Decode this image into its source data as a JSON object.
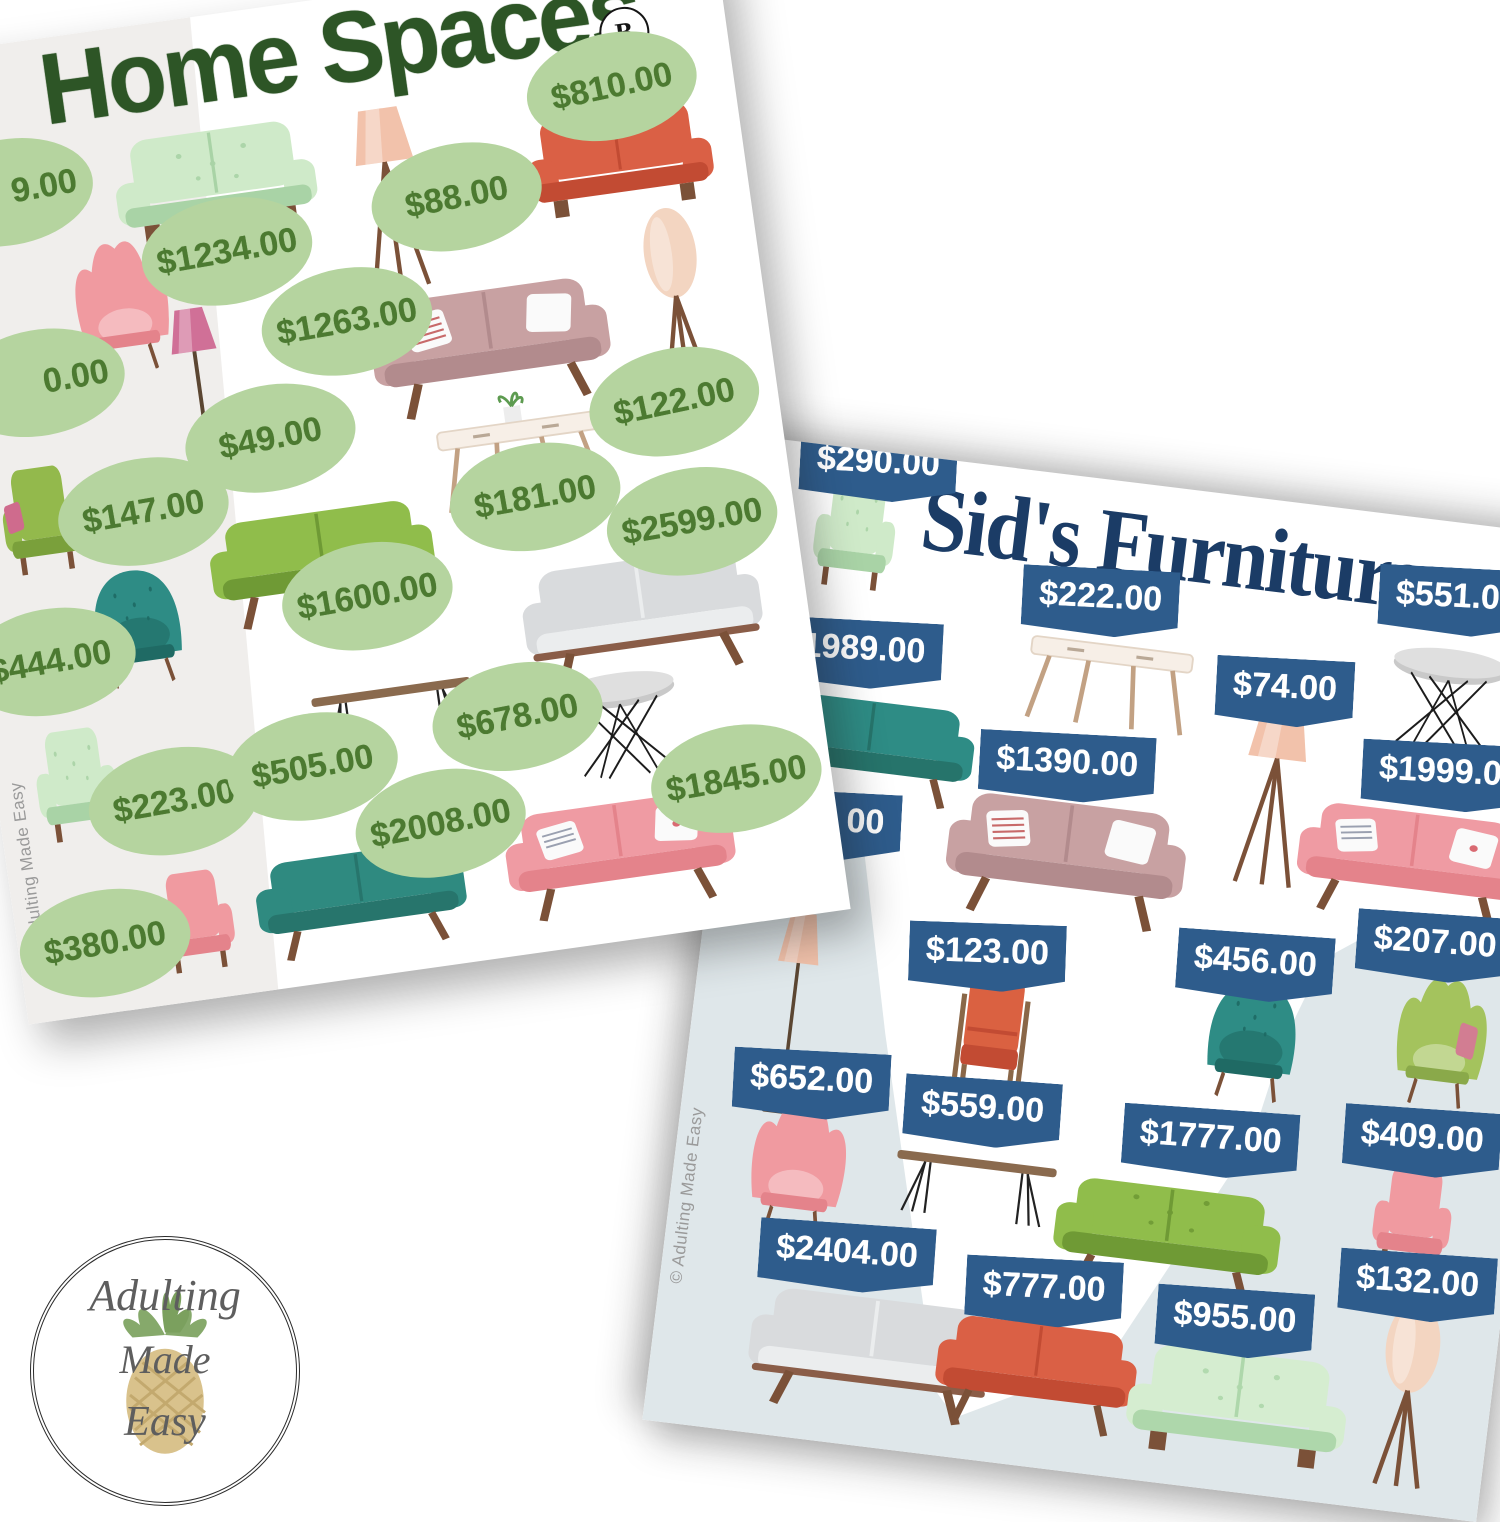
{
  "page": {
    "background": "#ffffff"
  },
  "home_card": {
    "title": "Home Spaces",
    "badge": "B",
    "copyright": "© Adulting Made Easy",
    "colors": {
      "title": "#2d5526",
      "tag_bg": "#b5d49f",
      "tag_text": "#4c7a31",
      "side_band": "#f0eeec"
    },
    "items": [
      {
        "name": "price-only-cut",
        "price": "9.00",
        "tag": {
          "x": 95,
          "y": 148,
          "rot": -2,
          "align": "right"
        },
        "furniture": null
      },
      {
        "name": "wing-chair-pink",
        "price": "0.00",
        "tag": {
          "x": 100,
          "y": 341,
          "rot": -2,
          "align": "right"
        },
        "furniture": {
          "k": "wing",
          "c": "#f09aa0",
          "d": "#e4838b",
          "x": 193,
          "y": 274,
          "w": 118,
          "h": 138
        }
      },
      {
        "name": "armchair-green",
        "price": "$147.00",
        "tag": {
          "x": 185,
          "y": 483,
          "rot": -2
        },
        "furniture": {
          "k": "arm",
          "c": "#93b94c",
          "d": "#7aa03b",
          "p": "#cf6b8d",
          "x": 83,
          "y": 479,
          "w": 110,
          "h": 124
        }
      },
      {
        "name": "tub-chair-teal",
        "price": "$444.00",
        "tag": {
          "x": 72,
          "y": 619,
          "rot": -2
        },
        "furniture": {
          "k": "tub",
          "c": "#2e8c85",
          "d": "#1f6a64",
          "x": 163,
          "y": 596,
          "w": 120,
          "h": 124
        }
      },
      {
        "name": "armchair-mint",
        "price": "$223.00",
        "tag": {
          "x": 175,
          "y": 774,
          "rot": -2
        },
        "furniture": {
          "k": "arm",
          "c": "#cfeac9",
          "d": "#a9d3a6",
          "s": 1,
          "x": 81,
          "y": 746,
          "w": 114,
          "h": 130
        }
      },
      {
        "name": "armchair-pink",
        "price": "$380.00",
        "tag": {
          "x": 87,
          "y": 905,
          "rot": -2
        },
        "furniture": {
          "k": "arm",
          "c": "#f09aa0",
          "d": "#e4838b",
          "x": 179,
          "y": 897,
          "w": 107,
          "h": 117
        }
      },
      {
        "name": "loveseat-mint",
        "price": "$1234.00",
        "tag": {
          "x": 304,
          "y": 237,
          "rot": -2
        },
        "furniture": {
          "k": "sofa2",
          "c": "#cfeac9",
          "d": "#a9d3a6",
          "s": 1,
          "x": 302,
          "y": 170,
          "w": 218,
          "h": 127
        }
      },
      {
        "name": "floor-lamp-tripod-peach",
        "price": "$88.00",
        "tag": {
          "x": 539,
          "y": 215,
          "rot": -3
        },
        "furniture": {
          "k": "tripod",
          "c": "#f2c2ab",
          "x": 472,
          "y": 207,
          "w": 97,
          "h": 192
        }
      },
      {
        "name": "loveseat-orange",
        "price": "$810.00",
        "tag": {
          "x": 708,
          "y": 127,
          "rot": -4
        },
        "furniture": {
          "k": "sofa2",
          "c": "#da6045",
          "d": "#c24b33",
          "x": 705,
          "y": 204,
          "w": 202,
          "h": 122
        }
      },
      {
        "name": "floor-lamp-pink",
        "price": "$49.00",
        "tag": {
          "x": 321,
          "y": 428,
          "rot": -3
        },
        "furniture": {
          "k": "pole",
          "c": "#d07097",
          "x": 257,
          "y": 374,
          "w": 87,
          "h": 187
        }
      },
      {
        "name": "sofa-mauve",
        "price": "$1263.00",
        "tag": {
          "x": 413,
          "y": 323,
          "rot": -2
        },
        "furniture": {
          "k": "sofa",
          "c": "#c8a1a2",
          "d": "#b28b8d",
          "pl": "mauve",
          "x": 552,
          "y": 362,
          "w": 248,
          "h": 137
        }
      },
      {
        "name": "floor-lamp-oval-beige",
        "price": "$122.00",
        "tag": {
          "x": 726,
          "y": 448,
          "rot": -4
        },
        "furniture": {
          "k": "oval",
          "c": "#f3d5c1",
          "x": 742,
          "y": 347,
          "w": 87,
          "h": 197
        }
      },
      {
        "name": "console-table",
        "price": "$181.00",
        "tag": {
          "x": 575,
          "y": 523,
          "rot": -2
        },
        "furniture": {
          "k": "console",
          "plant": 1,
          "x": 567,
          "y": 470,
          "w": 188,
          "h": 117
        }
      },
      {
        "name": "sofa-green",
        "price": "$1600.00",
        "tag": {
          "x": 395,
          "y": 598,
          "rot": -2
        },
        "furniture": {
          "k": "sofa",
          "c": "#90bd4b",
          "d": "#6f9a35",
          "x": 355,
          "y": 554,
          "w": 233,
          "h": 124
        }
      },
      {
        "name": "sofa-gray",
        "price": "$2599.00",
        "tag": {
          "x": 727,
          "y": 569,
          "rot": -2
        },
        "furniture": {
          "k": "sofa",
          "c": "#d9dbdd",
          "d": "#ebedee",
          "frame": 1,
          "x": 665,
          "y": 650,
          "w": 248,
          "h": 137
        }
      },
      {
        "name": "coffee-table-hairpin",
        "price": "$505.00",
        "tag": {
          "x": 317,
          "y": 759,
          "rot": -2
        },
        "furniture": {
          "k": "hairpin",
          "x": 405,
          "y": 702,
          "w": 178,
          "h": 102
        }
      },
      {
        "name": "side-table-wire",
        "price": "$678.00",
        "tag": {
          "x": 527,
          "y": 738,
          "rot": -3
        },
        "furniture": {
          "k": "wire",
          "x": 630,
          "y": 754,
          "w": 138,
          "h": 120
        }
      },
      {
        "name": "sofa-teal",
        "price": "$2008.00",
        "tag": {
          "x": 436,
          "y": 833,
          "rot": -3
        },
        "furniture": {
          "k": "sofa",
          "c": "#2f8a80",
          "d": "#27756c",
          "x": 347,
          "y": 893,
          "w": 218,
          "h": 114
        }
      },
      {
        "name": "sofa-pink",
        "price": "$1845.00",
        "tag": {
          "x": 735,
          "y": 830,
          "rot": -2
        },
        "furniture": {
          "k": "sofa",
          "c": "#ef9ba3",
          "d": "#e4838b",
          "pl": "pink",
          "x": 610,
          "y": 884,
          "w": 238,
          "h": 124
        }
      }
    ]
  },
  "sids_card": {
    "title": "Sid's Furniture",
    "copyright": "© Adulting Made Easy",
    "colors": {
      "title": "#1b3c66",
      "tag_bg": "#2e5c8c",
      "tag_text": "#ffffff",
      "floor_shade": "#dfe7ea"
    },
    "items": [
      {
        "name": "armchair-mint",
        "price": "$290.00",
        "tag": {
          "x": 118,
          "y": 16,
          "rot": -4
        },
        "furniture": {
          "k": "arm",
          "c": "#cfeac9",
          "d": "#a9d3a6",
          "s": 1,
          "x": 103,
          "y": 86,
          "w": 114,
          "h": 130
        }
      },
      {
        "name": "sofa-teal",
        "price": "$1989.00",
        "tag": {
          "x": 117,
          "y": 204,
          "rot": -4
        },
        "furniture": {
          "k": "sofa",
          "c": "#2e8c85",
          "d": "#26746b",
          "x": 143,
          "y": 292,
          "w": 218,
          "h": 114
        }
      },
      {
        "name": "console-table",
        "price": "$222.00",
        "tag": {
          "x": 355,
          "y": 123,
          "rot": -4
        },
        "furniture": {
          "k": "console",
          "x": 373,
          "y": 188,
          "w": 188,
          "h": 117
        }
      },
      {
        "name": "side-table-wire",
        "price": "$551.00",
        "tag": {
          "x": 709,
          "y": 79,
          "rot": -4
        },
        "furniture": {
          "k": "wire",
          "x": 710,
          "y": 172,
          "w": 138,
          "h": 120
        }
      },
      {
        "name": "floor-lamp-tripod-peach",
        "price": "$74.00",
        "tag": {
          "x": 549,
          "y": 190,
          "rot": -4
        },
        "furniture": {
          "k": "tripod",
          "c": "#f2c2ab",
          "x": 549,
          "y": 293,
          "w": 97,
          "h": 192
        }
      },
      {
        "name": "sofa-mauve",
        "price": "$1390.00",
        "tag": {
          "x": 342,
          "y": 291,
          "rot": -4
        },
        "furniture": {
          "k": "sofa",
          "c": "#c8a1a2",
          "d": "#b28b8d",
          "pl": "mauve",
          "x": 352,
          "y": 377,
          "w": 248,
          "h": 137
        }
      },
      {
        "name": "sofa-pink",
        "price": "$1999.00",
        "tag": {
          "x": 723,
          "y": 254,
          "rot": -4
        },
        "furniture": {
          "k": "sofa",
          "c": "#ef9ba3",
          "d": "#e4838b",
          "pl": "pink",
          "x": 696,
          "y": 340,
          "w": 238,
          "h": 124
        }
      },
      {
        "name": "floor-lamp-pole",
        "price": "00",
        "tag": {
          "x": 110,
          "y": 378,
          "rot": -4,
          "align": "right"
        },
        "furniture": {
          "k": "pole",
          "c": "#f2c2ab",
          "x": 99,
          "y": 568,
          "w": 78,
          "h": 218
        }
      },
      {
        "name": "chair-orange-wood",
        "price": "$123.00",
        "tag": {
          "x": 286,
          "y": 489,
          "rot": -5
        },
        "furniture": {
          "k": "armW",
          "c": "#da6141",
          "d": "#c24b33",
          "x": 300,
          "y": 565,
          "w": 114,
          "h": 130
        }
      },
      {
        "name": "tub-chair-teal",
        "price": "$456.00",
        "tag": {
          "x": 553,
          "y": 466,
          "rot": -3
        },
        "furniture": {
          "k": "tub",
          "c": "#2e8c85",
          "d": "#1f6a64",
          "x": 559,
          "y": 538,
          "w": 122,
          "h": 127
        }
      },
      {
        "name": "wing-chair-green",
        "price": "$207.00",
        "tag": {
          "x": 729,
          "y": 425,
          "rot": -3
        },
        "furniture": {
          "k": "wing",
          "c": "#a4c35d",
          "d": "#8aa94a",
          "p": "#d27d92",
          "x": 747,
          "y": 515,
          "w": 114,
          "h": 134
        }
      },
      {
        "name": "wing-chair-pink",
        "price": "$652.00",
        "tag": {
          "x": 127,
          "y": 637,
          "rot": -4
        },
        "furniture": {
          "k": "wing",
          "c": "#f09aa0",
          "d": "#e4838b",
          "x": 124,
          "y": 718,
          "w": 120,
          "h": 140
        }
      },
      {
        "name": "coffee-table-hairpin",
        "price": "$559.00",
        "tag": {
          "x": 300,
          "y": 644,
          "rot": -3
        },
        "furniture": {
          "k": "hairpin",
          "x": 301,
          "y": 701,
          "w": 178,
          "h": 102
        }
      },
      {
        "name": "sofa-green",
        "price": "$1777.00",
        "tag": {
          "x": 530,
          "y": 646,
          "rot": -3
        },
        "furniture": {
          "k": "sofa",
          "c": "#90bd4b",
          "d": "#6f9a35",
          "s": 1,
          "x": 498,
          "y": 742,
          "w": 235,
          "h": 124
        }
      },
      {
        "name": "armchair-pink",
        "price": "$409.00",
        "tag": {
          "x": 740,
          "y": 620,
          "rot": -3
        },
        "furniture": {
          "k": "arm",
          "c": "#f09aa0",
          "d": "#e4838b",
          "x": 740,
          "y": 698,
          "w": 110,
          "h": 120
        }
      },
      {
        "name": "sofa-gray",
        "price": "$2404.00",
        "tag": {
          "x": 183,
          "y": 804,
          "rot": -3
        },
        "furniture": {
          "k": "sofa",
          "c": "#d9dbdd",
          "d": "#ebedee",
          "frame": 1,
          "x": 219,
          "y": 892,
          "w": 255,
          "h": 134
        }
      },
      {
        "name": "sofa-orange",
        "price": "$777.00",
        "tag": {
          "x": 383,
          "y": 815,
          "rot": -4
        },
        "furniture": {
          "k": "sofa",
          "c": "#da6045",
          "d": "#c24b33",
          "x": 385,
          "y": 892,
          "w": 208,
          "h": 120
        }
      },
      {
        "name": "sofa-mint",
        "price": "$955.00",
        "tag": {
          "x": 576,
          "y": 822,
          "rot": -3
        },
        "furniture": {
          "k": "sofa2",
          "c": "#d5edd0",
          "d": "#aed7ab",
          "s": 1,
          "x": 589,
          "y": 908,
          "w": 238,
          "h": 130
        }
      },
      {
        "name": "floor-lamp-oval-beige",
        "price": "$132.00",
        "tag": {
          "x": 753,
          "y": 764,
          "rot": -3
        },
        "furniture": {
          "k": "oval",
          "c": "#f3d5c1",
          "x": 756,
          "y": 872,
          "w": 90,
          "h": 200
        }
      }
    ]
  },
  "logo": {
    "line1": "Adulting",
    "line2": "Made",
    "line3": "Easy",
    "icon": "pineapple-icon"
  }
}
